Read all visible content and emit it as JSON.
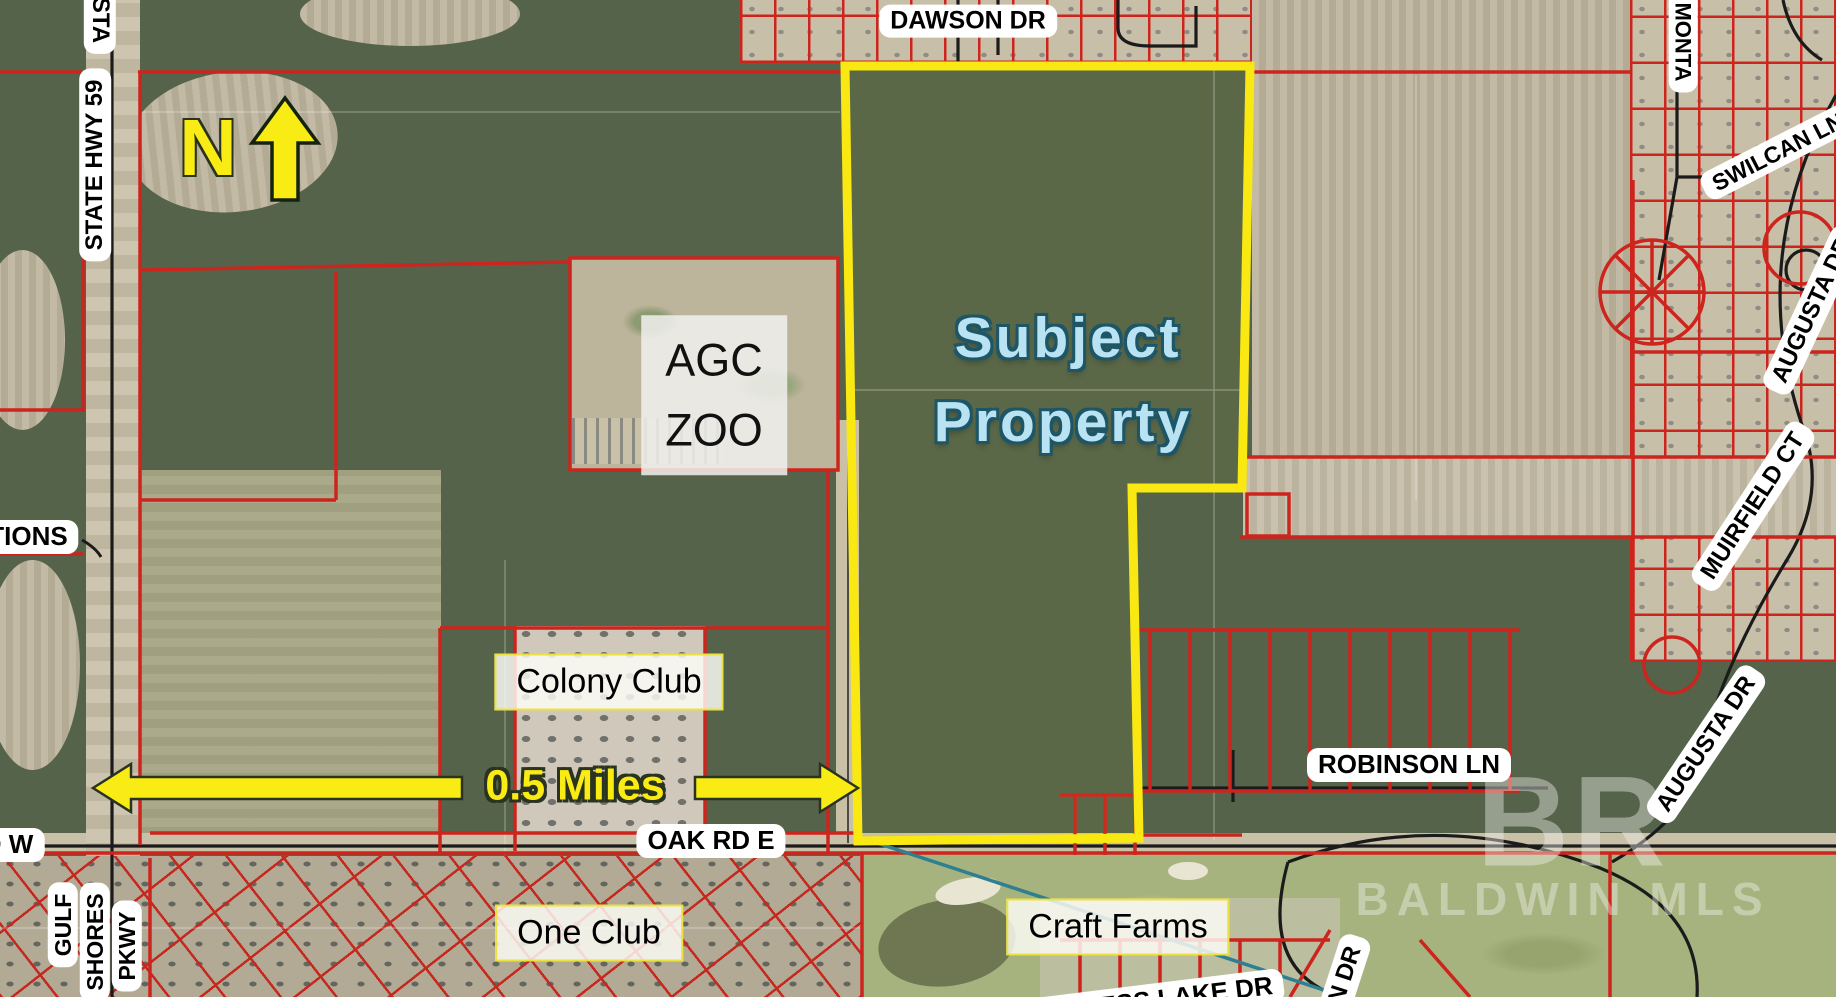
{
  "map": {
    "type": "aerial-real-estate-parcel-map",
    "annotations": {
      "subject_property_line1": "Subject",
      "subject_property_line2": "Property",
      "north_label": "N",
      "scale_label": "0.5 Miles"
    },
    "road_labels": {
      "dawson_dr": "DAWSON DR",
      "monta_partial": "MONTA",
      "swilcan_ln": "SWILCAN LN",
      "augusta_dr_top": "AUGUSTA DR",
      "augusta_dr_mid": "AUGUSTA DR",
      "muirfield_ct": "MUIRFIELD CT",
      "robinson_ln": "ROBINSON LN",
      "state_hwy_59": "STATE HWY 59",
      "state_hwy_partial": "STA",
      "tions_partial": "TIONS",
      "gulf": "GULF",
      "shores": "SHORES",
      "pkwy": "PKWY",
      "oak_rd_w_partial": "D W",
      "oak_rd_e": "OAK RD E",
      "cypress_lake_dr": "CYPRESS LAKE DR",
      "n_dr_partial": "N DR"
    },
    "place_labels": {
      "agc_zoo_line1": "AGC",
      "agc_zoo_line2": "ZOO",
      "colony_club": "Colony Club",
      "one_club": "One Club",
      "craft_farms": "Craft Farms"
    },
    "watermark": {
      "initials": "BR",
      "name": "BALDWIN MLS"
    },
    "colors": {
      "subject_boundary_yellow": "#F9E812",
      "parcel_line_red": "#CD241D",
      "road_line_black": "#1B1B1B",
      "subject_text_blue": "#B9E2F3",
      "scale_arrow_yellow": "#F9EC15",
      "utility_line_teal": "#2F7F91"
    }
  }
}
